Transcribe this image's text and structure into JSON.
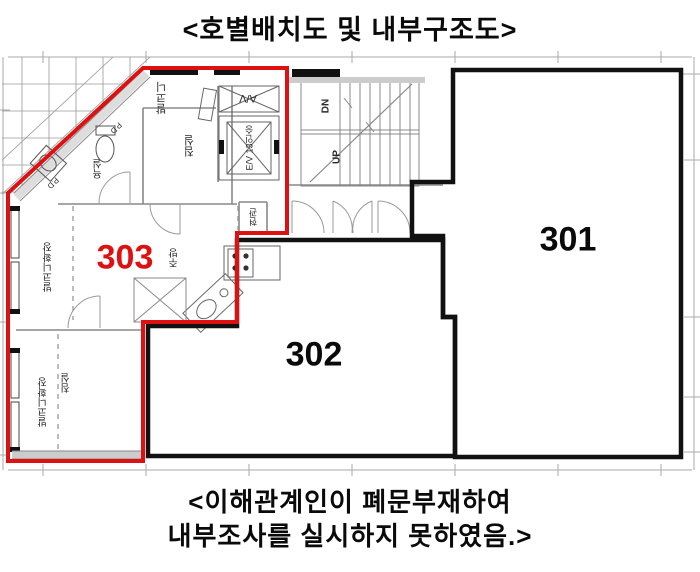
{
  "title": "<호별배치도 및 내부구조도>",
  "caption": {
    "line1": "<이해관계인이 폐문부재하여",
    "line2": "내부조사를 실시하지 못하였음.>"
  },
  "units": {
    "u301": {
      "label": "301"
    },
    "u302": {
      "label": "302"
    },
    "u303": {
      "label": "303"
    }
  },
  "rooms": {
    "balcony_top": "발코니",
    "bedroom_top": "침실",
    "bathroom": "욕실",
    "av_shaft": "A/V",
    "elevator": "E/V 13인승",
    "entrance": "현관",
    "kitchen": "주방",
    "bedroom_bottom": "침실",
    "balcony_ext_mid": "발코니확장",
    "balcony_ext_bottom": "발코니확장",
    "stair_down": "DN",
    "stair_up": "UP",
    "pd_1": "P.D",
    "pd_2": "P.D"
  },
  "colors": {
    "highlight_unit_outline": "#dd1111",
    "unit_outline": "#111111",
    "thin_line": "#888888",
    "property_line": "#aaaaaa"
  }
}
